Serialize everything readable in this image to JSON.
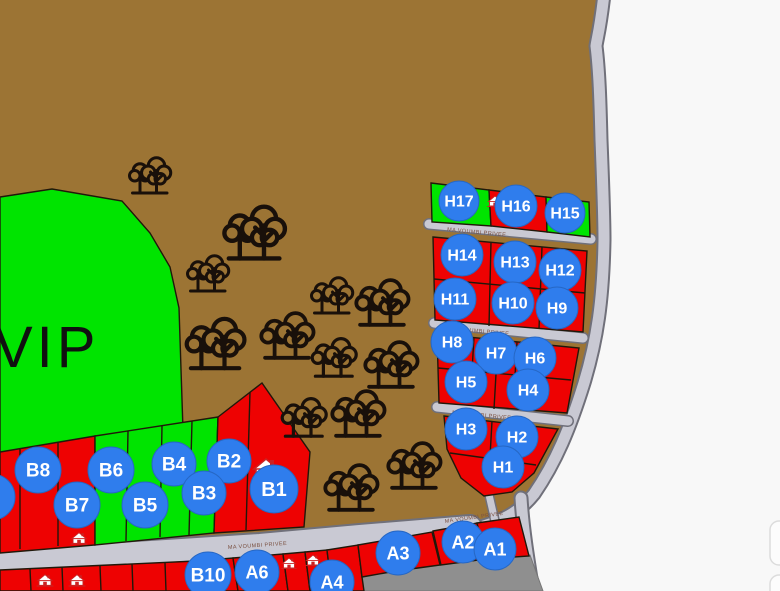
{
  "map": {
    "region_label": "VIP",
    "road_name": "MA VOUMBI PRIVEE",
    "legend_semantics": {
      "green_plot": "available",
      "red_plot": "reserved",
      "blue_circle": "plot-id-marker",
      "house_icon": "sold-house-marker"
    },
    "colors": {
      "land": "#9c7434",
      "available_green": "#00e400",
      "reserved_red": "#ee0202",
      "marker_blue": "#2f7ded",
      "road_gray": "#c9c9d3",
      "road_edge": "#70707a",
      "junction_dark_gray": "#8f8f8f",
      "background": "#f8f8f8",
      "tree_black": "#19100a"
    },
    "labels": {
      "h17": "H17",
      "h16": "H16",
      "h15": "H15",
      "h14": "H14",
      "h13": "H13",
      "h12": "H12",
      "h11": "H11",
      "h10": "H10",
      "h9": "H9",
      "h8": "H8",
      "h7": "H7",
      "h6": "H6",
      "h5": "H5",
      "h4": "H4",
      "h3": "H3",
      "h2": "H2",
      "h1": "H1",
      "b1": "B1",
      "b2": "B2",
      "b3": "B3",
      "b4": "B4",
      "b5": "B5",
      "b6": "B6",
      "b7": "B7",
      "b8": "B8",
      "b10": "B10",
      "a1": "A1",
      "a2": "A2",
      "a3": "A3",
      "a4": "A4",
      "a6": "A6"
    }
  }
}
